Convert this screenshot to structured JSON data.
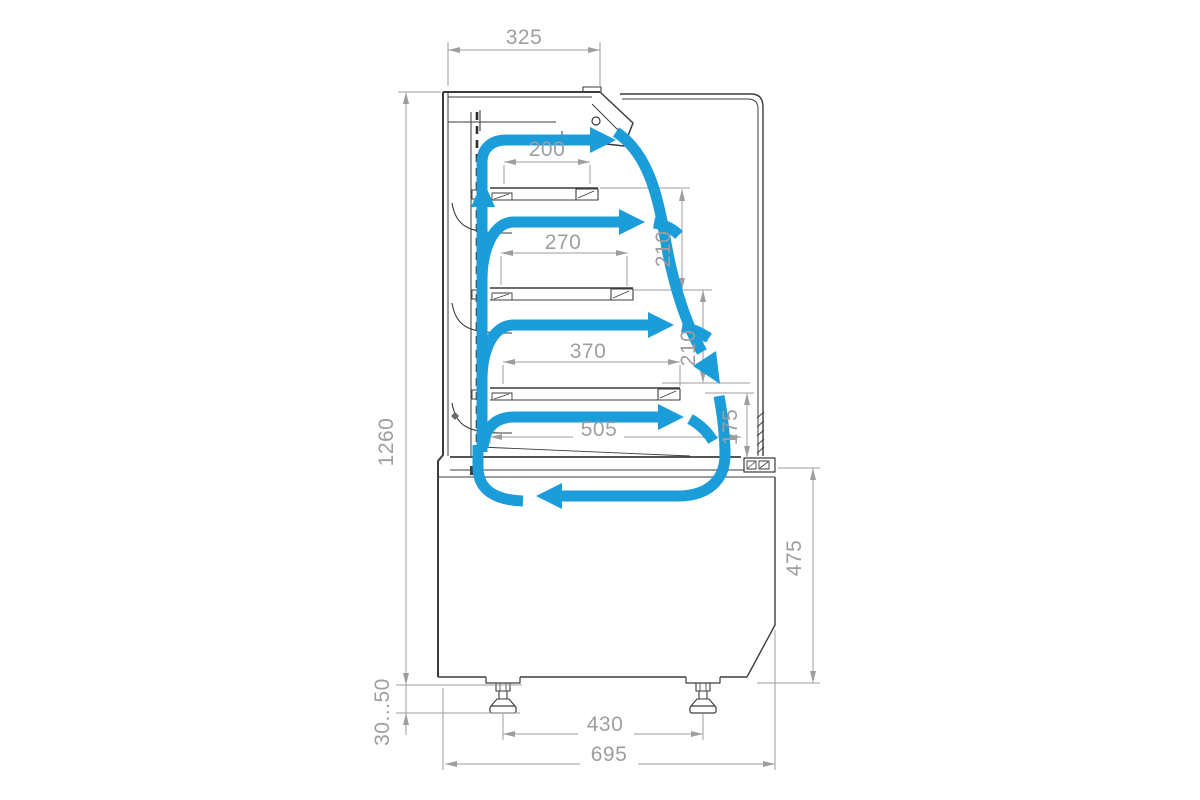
{
  "drawing": {
    "line_color": "#3d3d3d",
    "dim_color": "#9e9e9e",
    "airflow_color": "#1b9dd9",
    "background": "#ffffff"
  },
  "dims": {
    "top_depth": "325",
    "shelf1": "200",
    "shelf2": "270",
    "shelf3": "370",
    "base_shelf": "505",
    "gap1": "210",
    "gap2": "210",
    "gap3": "175",
    "total_height": "1260",
    "base_height": "475",
    "foot_range": "30...50",
    "foot_spacing": "430",
    "total_depth": "695"
  }
}
